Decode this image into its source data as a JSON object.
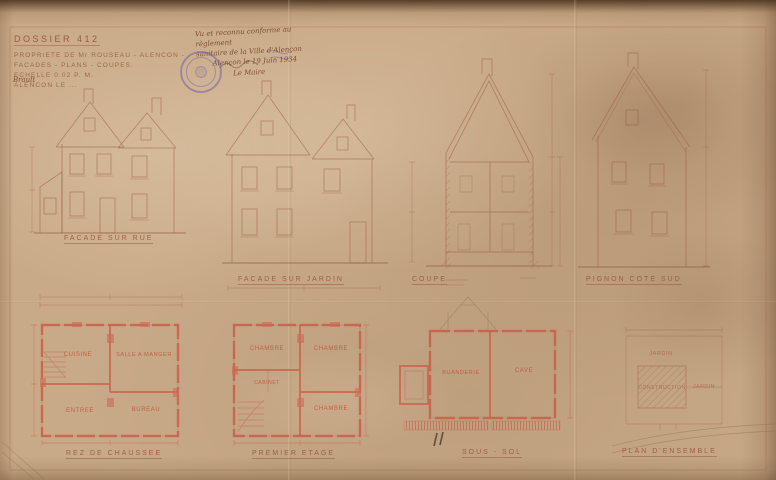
{
  "colors": {
    "paper": "#c9aa88",
    "ink_sepia": "#9a5a3c",
    "plan_red": "#cc5a46",
    "stamp_purple": "#5f50a8"
  },
  "title_block": {
    "line1": "DOSSIER 412",
    "line2": "PROPRIETE DE Mr ROUSEAU - ALENCON -",
    "line3": "FACADES - PLANS - COUPES.",
    "line4": "ECHELLE 0.02 P. M.",
    "line5": "ALENCON LE ...",
    "signature": "Brault"
  },
  "approval_note": {
    "line1": "Vu et reconnu conforme au règlement",
    "line2": "sanitaire de la Ville d'Alençon",
    "line3": "Alençon le 19 Juin 1934",
    "line4": "Le Maire"
  },
  "stamp_icon": "round-municipal-seal",
  "drawings": {
    "elevations": [
      {
        "label": "FACADE SUR RUE"
      },
      {
        "label": "FACADE SUR JARDIN"
      },
      {
        "label": "COUPE"
      },
      {
        "label": "PIGNON COTE SUD"
      }
    ],
    "plans": [
      {
        "label": "REZ DE CHAUSSEE",
        "rooms": [
          "CUISINE",
          "SALLE A MANGER",
          "ENTREE",
          "BUREAU"
        ]
      },
      {
        "label": "PREMIER ETAGE",
        "rooms": [
          "CHAMBRE",
          "CHAMBRE",
          "CABINET",
          "CHAMBRE"
        ]
      },
      {
        "label": "SOUS - SOL",
        "rooms": [
          "BUANDERIE",
          "CAVE"
        ]
      },
      {
        "label": "PLAN D'ENSEMBLE",
        "annotations": [
          "JARDIN",
          "CONSTRUCTION",
          "JARDIN"
        ]
      }
    ]
  }
}
